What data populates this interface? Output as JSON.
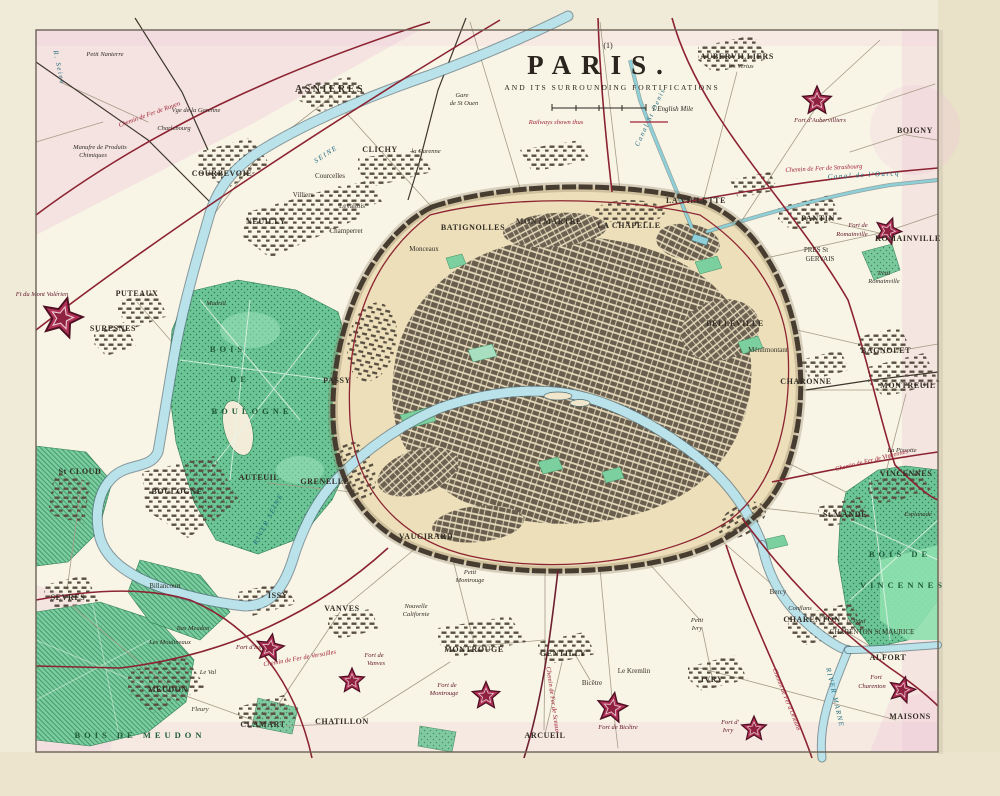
{
  "title_block": {
    "plate_number": "(1)",
    "title": "PARIS.",
    "subtitle": "AND ITS SURROUNDING FORTIFICATIONS",
    "scale_note": "1 English Mile",
    "railway_note": "Railways shown thus"
  },
  "colors": {
    "paper": "#f8f4e6",
    "city_tan": "#ecdfba",
    "park_green": "#6cc596",
    "water_blue": "#b9e2ea",
    "railway_red": "#8c2332",
    "fort_crimson": "#b13157",
    "pink_wash": "#eec3d6"
  },
  "forts": [
    {
      "x": 62,
      "y": 318,
      "s": 1.6,
      "rot": 15
    },
    {
      "x": 817,
      "y": 101,
      "s": 1.15,
      "rot": 0
    },
    {
      "x": 888,
      "y": 231,
      "s": 1.05,
      "rot": 20
    },
    {
      "x": 270,
      "y": 648,
      "s": 1.1,
      "rot": 10
    },
    {
      "x": 352,
      "y": 681,
      "s": 1.0,
      "rot": 0
    },
    {
      "x": 486,
      "y": 696,
      "s": 1.1,
      "rot": 0
    },
    {
      "x": 612,
      "y": 708,
      "s": 1.2,
      "rot": 10
    },
    {
      "x": 754,
      "y": 729,
      "s": 1.0,
      "rot": 0
    },
    {
      "x": 902,
      "y": 690,
      "s": 1.05,
      "rot": 15
    }
  ],
  "map_labels": [
    {
      "t": "ASNIERES",
      "x": 330,
      "y": 92,
      "c": "t1"
    },
    {
      "t": "Gare",
      "x": 462,
      "y": 97,
      "c": "it"
    },
    {
      "t": "de St Ouen",
      "x": 464,
      "y": 105,
      "c": "it"
    },
    {
      "t": "CLICHY",
      "x": 380,
      "y": 152,
      "c": "t2"
    },
    {
      "t": "la Garenne",
      "x": 426,
      "y": 153,
      "c": "it"
    },
    {
      "t": "COURBEVOIE",
      "x": 222,
      "y": 176,
      "c": "t2"
    },
    {
      "t": "Courcelles",
      "x": 330,
      "y": 178,
      "c": "t3"
    },
    {
      "t": "Villiers",
      "x": 303,
      "y": 197,
      "c": "t3"
    },
    {
      "t": "Levallois",
      "x": 352,
      "y": 208,
      "c": "t3"
    },
    {
      "t": "NEUILLY",
      "x": 266,
      "y": 224,
      "c": "t2",
      "ls": 2
    },
    {
      "t": "Champerret",
      "x": 346,
      "y": 233,
      "c": "t3"
    },
    {
      "t": "Monceaux",
      "x": 424,
      "y": 251,
      "c": "t3"
    },
    {
      "t": "BATIGNOLLES",
      "x": 473,
      "y": 230,
      "c": "t2"
    },
    {
      "t": "MONTMARTRE",
      "x": 549,
      "y": 224,
      "c": "t2"
    },
    {
      "t": "LA CHAPELLE",
      "x": 629,
      "y": 228,
      "c": "t2"
    },
    {
      "t": "LA VILLETTE",
      "x": 696,
      "y": 203,
      "c": "t2"
    },
    {
      "t": "AUBERVILLIERS",
      "x": 737,
      "y": 59,
      "c": "t2"
    },
    {
      "t": "les Vertus",
      "x": 741,
      "y": 68,
      "c": "it"
    },
    {
      "t": "Fort d'Aubervilliers",
      "x": 820,
      "y": 122,
      "c": "fortl"
    },
    {
      "t": "BOIGNY",
      "x": 915,
      "y": 133,
      "c": "t2"
    },
    {
      "t": "PANTIN",
      "x": 818,
      "y": 221,
      "c": "t2",
      "ls": 2
    },
    {
      "t": "ROMAINVILLE",
      "x": 908,
      "y": 241,
      "c": "t2"
    },
    {
      "t": "Fort de",
      "x": 858,
      "y": 227,
      "c": "fortl"
    },
    {
      "t": "Romainville",
      "x": 852,
      "y": 236,
      "c": "fortl"
    },
    {
      "t": "PRES St",
      "x": 816,
      "y": 252,
      "c": "t3"
    },
    {
      "t": "GERVAIS",
      "x": 820,
      "y": 261,
      "c": "t3"
    },
    {
      "t": "Petit",
      "x": 884,
      "y": 275,
      "c": "it"
    },
    {
      "t": "Romainville",
      "x": 884,
      "y": 283,
      "c": "it"
    },
    {
      "t": "BELLEVILLE",
      "x": 735,
      "y": 326,
      "c": "t2"
    },
    {
      "t": "Ménilmontant",
      "x": 768,
      "y": 352,
      "c": "t3"
    },
    {
      "t": "CHARONNE",
      "x": 806,
      "y": 384,
      "c": "t2"
    },
    {
      "t": "BAGNOLET",
      "x": 886,
      "y": 353,
      "c": "t2"
    },
    {
      "t": "MONTREUIL",
      "x": 908,
      "y": 388,
      "c": "t2",
      "ls": 1
    },
    {
      "t": "La Pissotte",
      "x": 902,
      "y": 452,
      "c": "it"
    },
    {
      "t": "VINCENNES",
      "x": 906,
      "y": 476,
      "c": "t2"
    },
    {
      "t": "St MANDE",
      "x": 845,
      "y": 517,
      "c": "t2"
    },
    {
      "t": "Esplanade",
      "x": 918,
      "y": 516,
      "c": "it"
    },
    {
      "t": "BOIS DE",
      "x": 900,
      "y": 557,
      "c": "wood",
      "ls": 3
    },
    {
      "t": "VINCENNES",
      "x": 903,
      "y": 588,
      "c": "wood",
      "ls": 2
    },
    {
      "t": "Bercy",
      "x": 778,
      "y": 594,
      "c": "t3"
    },
    {
      "t": "CHARENTON",
      "x": 812,
      "y": 622,
      "c": "t2"
    },
    {
      "t": "le Pont",
      "x": 856,
      "y": 623,
      "c": "it"
    },
    {
      "t": "CHARENTON St MAURICE",
      "x": 872,
      "y": 634,
      "c": "t3"
    },
    {
      "t": "Conflans",
      "x": 800,
      "y": 610,
      "c": "it"
    },
    {
      "t": "ALFORT",
      "x": 888,
      "y": 660,
      "c": "t2"
    },
    {
      "t": "Fort",
      "x": 876,
      "y": 679,
      "c": "fortl"
    },
    {
      "t": "Charenton",
      "x": 872,
      "y": 688,
      "c": "fortl"
    },
    {
      "t": "MAISONS",
      "x": 910,
      "y": 719,
      "c": "t2"
    },
    {
      "t": "Fort d'",
      "x": 730,
      "y": 724,
      "c": "fortl"
    },
    {
      "t": "Ivry",
      "x": 728,
      "y": 732,
      "c": "fortl"
    },
    {
      "t": "IVRY",
      "x": 712,
      "y": 682,
      "c": "t2",
      "ls": 2
    },
    {
      "t": "Petit",
      "x": 697,
      "y": 622,
      "c": "it"
    },
    {
      "t": "Ivry",
      "x": 697,
      "y": 630,
      "c": "it"
    },
    {
      "t": "Le Kremlin",
      "x": 634,
      "y": 673,
      "c": "t3"
    },
    {
      "t": "Bicêtre",
      "x": 592,
      "y": 685,
      "c": "t3"
    },
    {
      "t": "Fort de Bicêtre",
      "x": 618,
      "y": 729,
      "c": "fortl"
    },
    {
      "t": "GENTILLY",
      "x": 563,
      "y": 656,
      "c": "t2",
      "ls": 1
    },
    {
      "t": "ARCUEIL",
      "x": 545,
      "y": 738,
      "c": "t2"
    },
    {
      "t": "MONTROUGE",
      "x": 474,
      "y": 652,
      "c": "t2",
      "ls": 1
    },
    {
      "t": "Fort de",
      "x": 447,
      "y": 687,
      "c": "fortl"
    },
    {
      "t": "Montrouge",
      "x": 444,
      "y": 695,
      "c": "fortl"
    },
    {
      "t": "Nouvelle",
      "x": 416,
      "y": 608,
      "c": "it"
    },
    {
      "t": "Californie",
      "x": 416,
      "y": 616,
      "c": "it"
    },
    {
      "t": "Petit",
      "x": 470,
      "y": 574,
      "c": "it"
    },
    {
      "t": "Montrouge",
      "x": 470,
      "y": 582,
      "c": "it"
    },
    {
      "t": "CHATILLON",
      "x": 342,
      "y": 724,
      "c": "t2",
      "ls": 1
    },
    {
      "t": "CLAMART",
      "x": 263,
      "y": 727,
      "c": "t2",
      "ls": 1
    },
    {
      "t": "Fleury",
      "x": 200,
      "y": 711,
      "c": "it"
    },
    {
      "t": "MEUDON",
      "x": 168,
      "y": 692,
      "c": "t2",
      "ls": 2
    },
    {
      "t": "Le Val",
      "x": 208,
      "y": 674,
      "c": "it"
    },
    {
      "t": "BOIS DE MEUDON",
      "x": 140,
      "y": 738,
      "c": "wood",
      "ls": 5
    },
    {
      "t": "Bas Meudon",
      "x": 193,
      "y": 630,
      "c": "it"
    },
    {
      "t": "Les Moulineaux",
      "x": 170,
      "y": 644,
      "c": "it"
    },
    {
      "t": "Fort d'Issy",
      "x": 250,
      "y": 649,
      "c": "fortl",
      "a": "end"
    },
    {
      "t": "Fort de",
      "x": 374,
      "y": 657,
      "c": "fortl"
    },
    {
      "t": "Vanves",
      "x": 376,
      "y": 665,
      "c": "fortl"
    },
    {
      "t": "VANVES",
      "x": 342,
      "y": 611,
      "c": "t2"
    },
    {
      "t": "ISSY",
      "x": 278,
      "y": 598,
      "c": "t2",
      "ls": 3
    },
    {
      "t": "SEVRES",
      "x": 68,
      "y": 600,
      "c": "t2",
      "ls": 1
    },
    {
      "t": "Billancourt",
      "x": 165,
      "y": 588,
      "c": "t3"
    },
    {
      "t": "St CLOUD",
      "x": 80,
      "y": 474,
      "c": "t2"
    },
    {
      "t": "BOULOGNE",
      "x": 177,
      "y": 494,
      "c": "t2",
      "ls": 1
    },
    {
      "t": "AUTEUIL",
      "x": 259,
      "y": 480,
      "c": "t2"
    },
    {
      "t": "GRENELLE",
      "x": 325,
      "y": 484,
      "c": "t2"
    },
    {
      "t": "VAUGIRARD",
      "x": 426,
      "y": 539,
      "c": "t2"
    },
    {
      "t": "PASSY",
      "x": 337,
      "y": 383,
      "c": "t2"
    },
    {
      "t": "BOIS",
      "x": 228,
      "y": 352,
      "c": "wood",
      "ls": 8
    },
    {
      "t": "DE",
      "x": 240,
      "y": 382,
      "c": "wood",
      "ls": 6
    },
    {
      "t": "BOULOGNE",
      "x": 252,
      "y": 414,
      "c": "wood",
      "ls": 4
    },
    {
      "t": "Madrid",
      "x": 216,
      "y": 305,
      "c": "it"
    },
    {
      "t": "PUTEAUX",
      "x": 137,
      "y": 296,
      "c": "t2"
    },
    {
      "t": "SURESNES",
      "x": 113,
      "y": 331,
      "c": "t2"
    },
    {
      "t": "Ft du Mont Valérien",
      "x": 42,
      "y": 296,
      "c": "fortl",
      "a": "start"
    },
    {
      "t": "Petit Nanterre",
      "x": 105,
      "y": 56,
      "c": "it"
    },
    {
      "t": "Charlebourg",
      "x": 174,
      "y": 130,
      "c": "it"
    },
    {
      "t": "Vge de la Garenne",
      "x": 196,
      "y": 112,
      "c": "it"
    },
    {
      "t": "Manufre de Produits",
      "x": 100,
      "y": 149,
      "c": "it"
    },
    {
      "t": "Chimiques",
      "x": 93,
      "y": 157,
      "c": "it"
    },
    {
      "t": "SEINE",
      "x": 327,
      "y": 156,
      "c": "wat",
      "rot": -33,
      "ls": 3
    },
    {
      "t": "R. Seine",
      "x": 57,
      "y": 68,
      "c": "wat",
      "rot": 78
    },
    {
      "t": "RIVER SEINE",
      "x": 270,
      "y": 520,
      "c": "wat",
      "rot": -62,
      "ls": 1
    },
    {
      "t": "RIVER MARNE",
      "x": 833,
      "y": 698,
      "c": "wat",
      "rot": 77,
      "ls": 1
    },
    {
      "t": "Canal de l'Ourcq",
      "x": 864,
      "y": 177,
      "c": "wat",
      "rot": -3
    },
    {
      "t": "Canal St Denis",
      "x": 652,
      "y": 118,
      "c": "wat",
      "rot": -65
    },
    {
      "t": "Chemin de Fer de Rouen",
      "x": 150,
      "y": 116,
      "c": "red",
      "rot": -20
    },
    {
      "t": "Chemin de Fer de Strasbourg",
      "x": 824,
      "y": 170,
      "c": "red",
      "rot": -3
    },
    {
      "t": "Chemin de Fer de Versailles",
      "x": 300,
      "y": 660,
      "c": "red",
      "rot": -10
    },
    {
      "t": "Chemin de Fer de Sceaux",
      "x": 551,
      "y": 700,
      "c": "red",
      "rot": 82
    },
    {
      "t": "Chemin de Fer d'Orléans",
      "x": 785,
      "y": 700,
      "c": "red",
      "rot": 68
    },
    {
      "t": "Chemin de Fer de Vincennes",
      "x": 872,
      "y": 462,
      "c": "red",
      "rot": -14
    }
  ]
}
